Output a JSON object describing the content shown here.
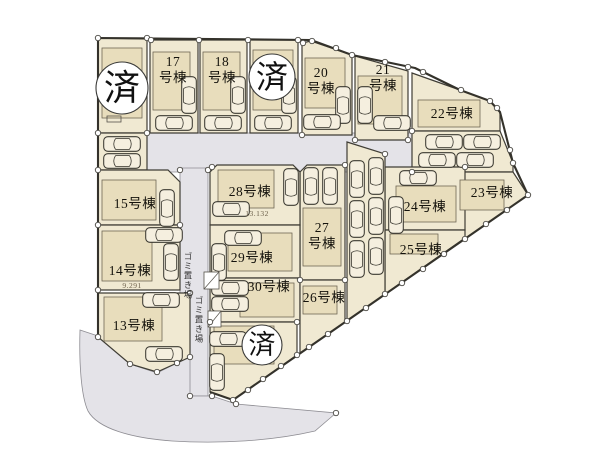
{
  "plan": {
    "type": "residential-site-plan",
    "sold_markers": [
      {
        "label": "済"
      },
      {
        "label": "済"
      },
      {
        "label": "済"
      }
    ],
    "lots": [
      {
        "id": "17",
        "line1": "17",
        "line2": "号棟"
      },
      {
        "id": "18",
        "line1": "18",
        "line2": "号棟"
      },
      {
        "id": "20",
        "line1": "20",
        "line2": "号棟"
      },
      {
        "id": "21",
        "line1": "21",
        "line2": "号棟"
      },
      {
        "id": "27",
        "line1": "27",
        "line2": "号棟"
      },
      {
        "id": "22",
        "label": "22号棟"
      },
      {
        "id": "23",
        "label": "23号棟"
      },
      {
        "id": "24",
        "label": "24号棟"
      },
      {
        "id": "25",
        "label": "25号棟"
      },
      {
        "id": "26",
        "label": "26号棟"
      },
      {
        "id": "28",
        "label": "28号棟"
      },
      {
        "id": "29",
        "label": "29号棟"
      },
      {
        "id": "30",
        "label": "30号棟"
      },
      {
        "id": "15",
        "label": "15号棟"
      },
      {
        "id": "14",
        "label": "14号棟"
      },
      {
        "id": "13",
        "label": "13号棟"
      }
    ],
    "annotations": {
      "lot28_dimension": "13.132",
      "lot14_dimension": "9.291",
      "garbage_area_1": "ゴミ置き場",
      "garbage_area_2": "ゴミ置き場"
    },
    "colors": {
      "lot_fill": "#f0e9d2",
      "building_fill": "#e8ddbc",
      "road_fill": "#e4e3e8",
      "outline": "#3f3d35",
      "sold_circle_fill": "#ffffff"
    }
  }
}
